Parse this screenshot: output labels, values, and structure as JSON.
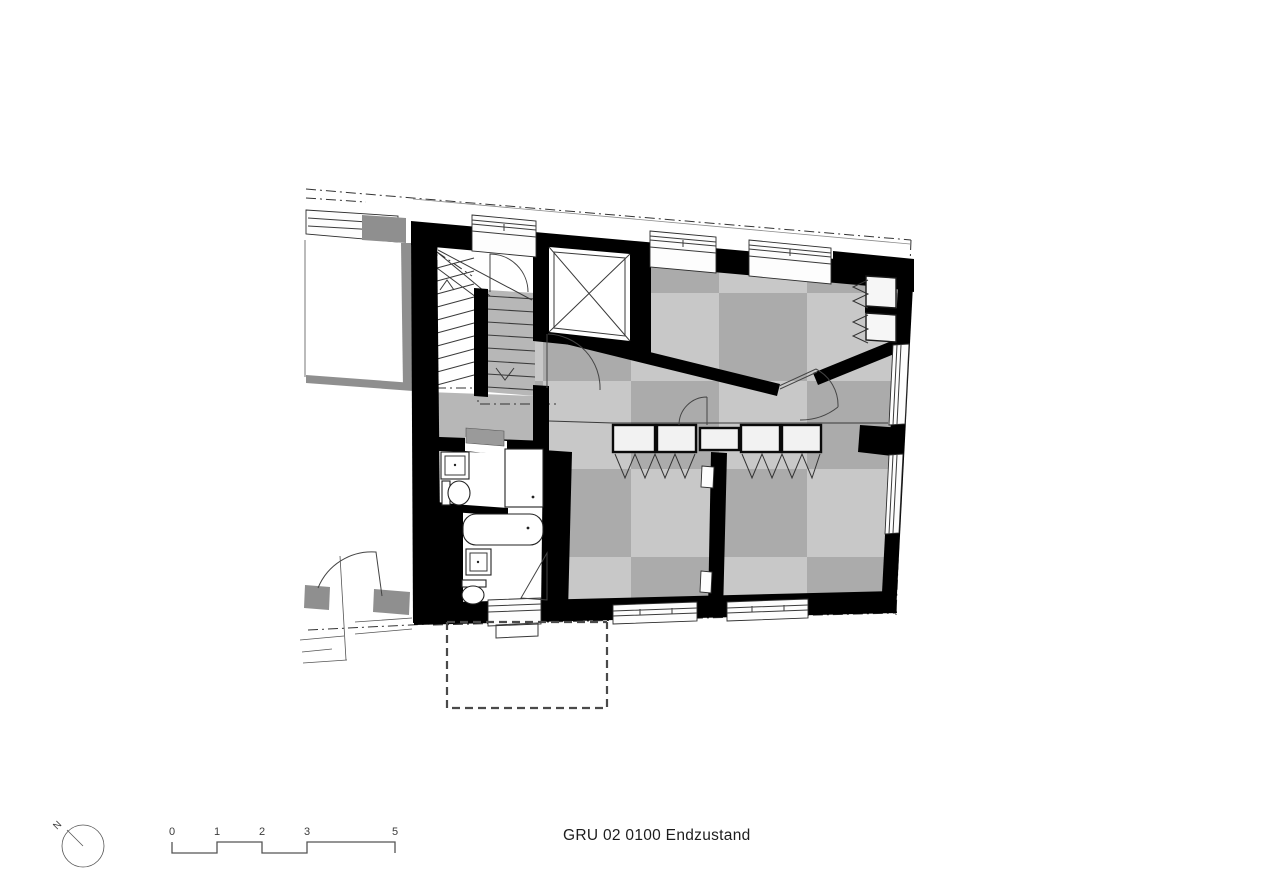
{
  "drawing": {
    "title": "GRU 02 0100 Endzustand"
  },
  "north_indicator": {
    "label": "N"
  },
  "scale_bar": {
    "labels": [
      "0",
      "1",
      "2",
      "3",
      "5"
    ]
  },
  "colors": {
    "wall": "#000000",
    "floor_light": "#c8c8c8",
    "floor_mid": "#ababab",
    "stair_gray": "#b7b7b7",
    "neighbor": "#8f8f8f",
    "line": "#3a3a3a",
    "dash": "#4a4a4a",
    "bg": "#ffffff"
  },
  "plan": {
    "symbols": [
      "exterior-wall",
      "interior-wall",
      "window",
      "door-swing",
      "stair-flight-up",
      "stair-flight-down",
      "elevator-shaft",
      "wc-toilet",
      "washbasin",
      "shower",
      "bathtub",
      "wardrobe-row",
      "clothes-hooks",
      "checkered-floor",
      "terrace-dashed-outline",
      "parcel-boundary",
      "neighbor-building"
    ]
  }
}
